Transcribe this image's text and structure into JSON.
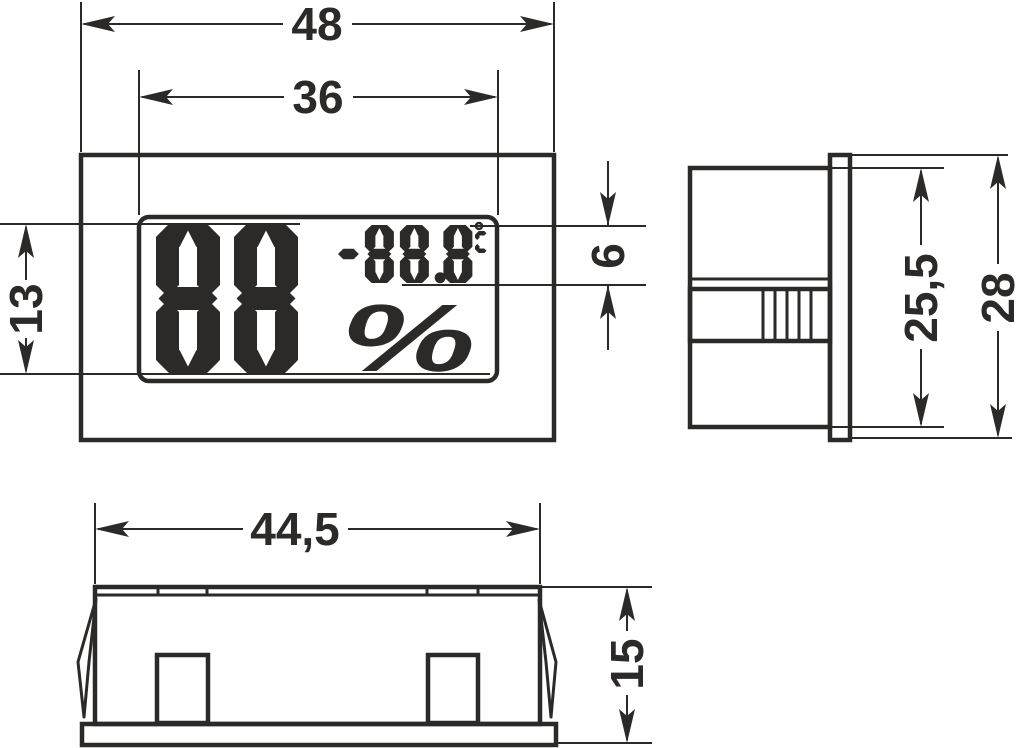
{
  "colors": {
    "line": "#2b2a29",
    "background": "#ffffff"
  },
  "display": {
    "humidity_value": "88",
    "humidity_unit": "%",
    "temperature_value": "-88.8",
    "degree_symbol": "°",
    "celsius_letter": "C"
  },
  "dimensions": {
    "front_width": "48",
    "display_width": "36",
    "digits_height": "13",
    "small_digits_height": "6",
    "body_height": "25,5",
    "flange_height": "28",
    "body_width": "44,5",
    "depth": "15"
  }
}
